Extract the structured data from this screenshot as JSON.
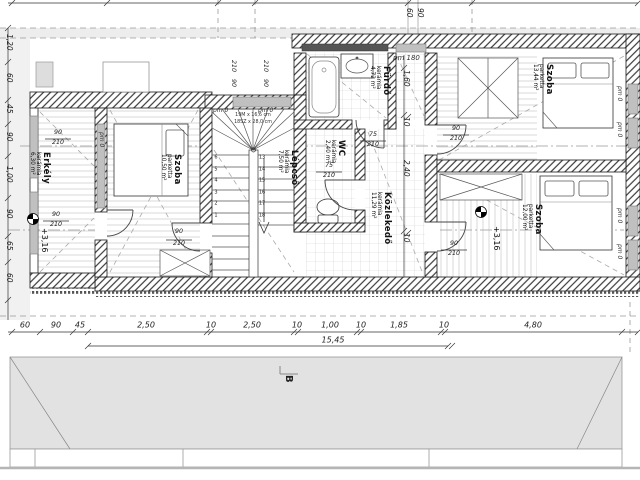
{
  "rooms": {
    "erkely": {
      "name": "Erkély",
      "material": "kerámia",
      "area": "6,30 m²"
    },
    "szoba_left": {
      "name": "Szoba",
      "material": "parketta",
      "area": "10,50 m²"
    },
    "lepcso": {
      "name": "Lépcső",
      "material": "kerámia",
      "area": "7,50 m²"
    },
    "furdo": {
      "name": "Fürdő",
      "material": "kerámia",
      "area": "4,72 m²"
    },
    "wc": {
      "name": "WC",
      "material": "kerámia",
      "area": "2,40 m²"
    },
    "kozlekedo": {
      "name": "Közlekedő",
      "material": "kerámia",
      "area": "11,29 m²"
    },
    "szoba_top_right": {
      "name": "Szoba",
      "material": "parketta",
      "area": "13,44 m²"
    },
    "szoba_bottom_right": {
      "name": "Szoba",
      "material": "parketta",
      "area": "12,00 m²"
    }
  },
  "levels": {
    "balcony": "+3,16",
    "bedroom": "+3,16"
  },
  "stairs": {
    "spec1": "19M x 16,6 cm",
    "spec2": "18SZ x 28,0 cm",
    "down_numbers": [
      "6",
      "5",
      "4",
      "3",
      "2",
      "1"
    ],
    "up_numbers": [
      "13",
      "14",
      "15",
      "16",
      "17",
      "18"
    ]
  },
  "openings": {
    "w90": "90",
    "w75": "75",
    "h210": "210",
    "pm0": "pm 0",
    "pm180": "pm 180"
  },
  "dims": {
    "top_right": [
      "60",
      "90"
    ],
    "left": [
      "1,20",
      "60",
      "45",
      "90",
      "1,00",
      "90",
      "65",
      "60"
    ],
    "bottom": [
      "60",
      "90",
      "45",
      "2,50",
      "10",
      "2,50",
      "10",
      "1,00",
      "10",
      "1,85",
      "10",
      "4,80"
    ],
    "bottom_total": "15,45",
    "corridor": [
      "1,60",
      "10",
      "2,40",
      "10"
    ]
  },
  "section": {
    "label": "B"
  }
}
